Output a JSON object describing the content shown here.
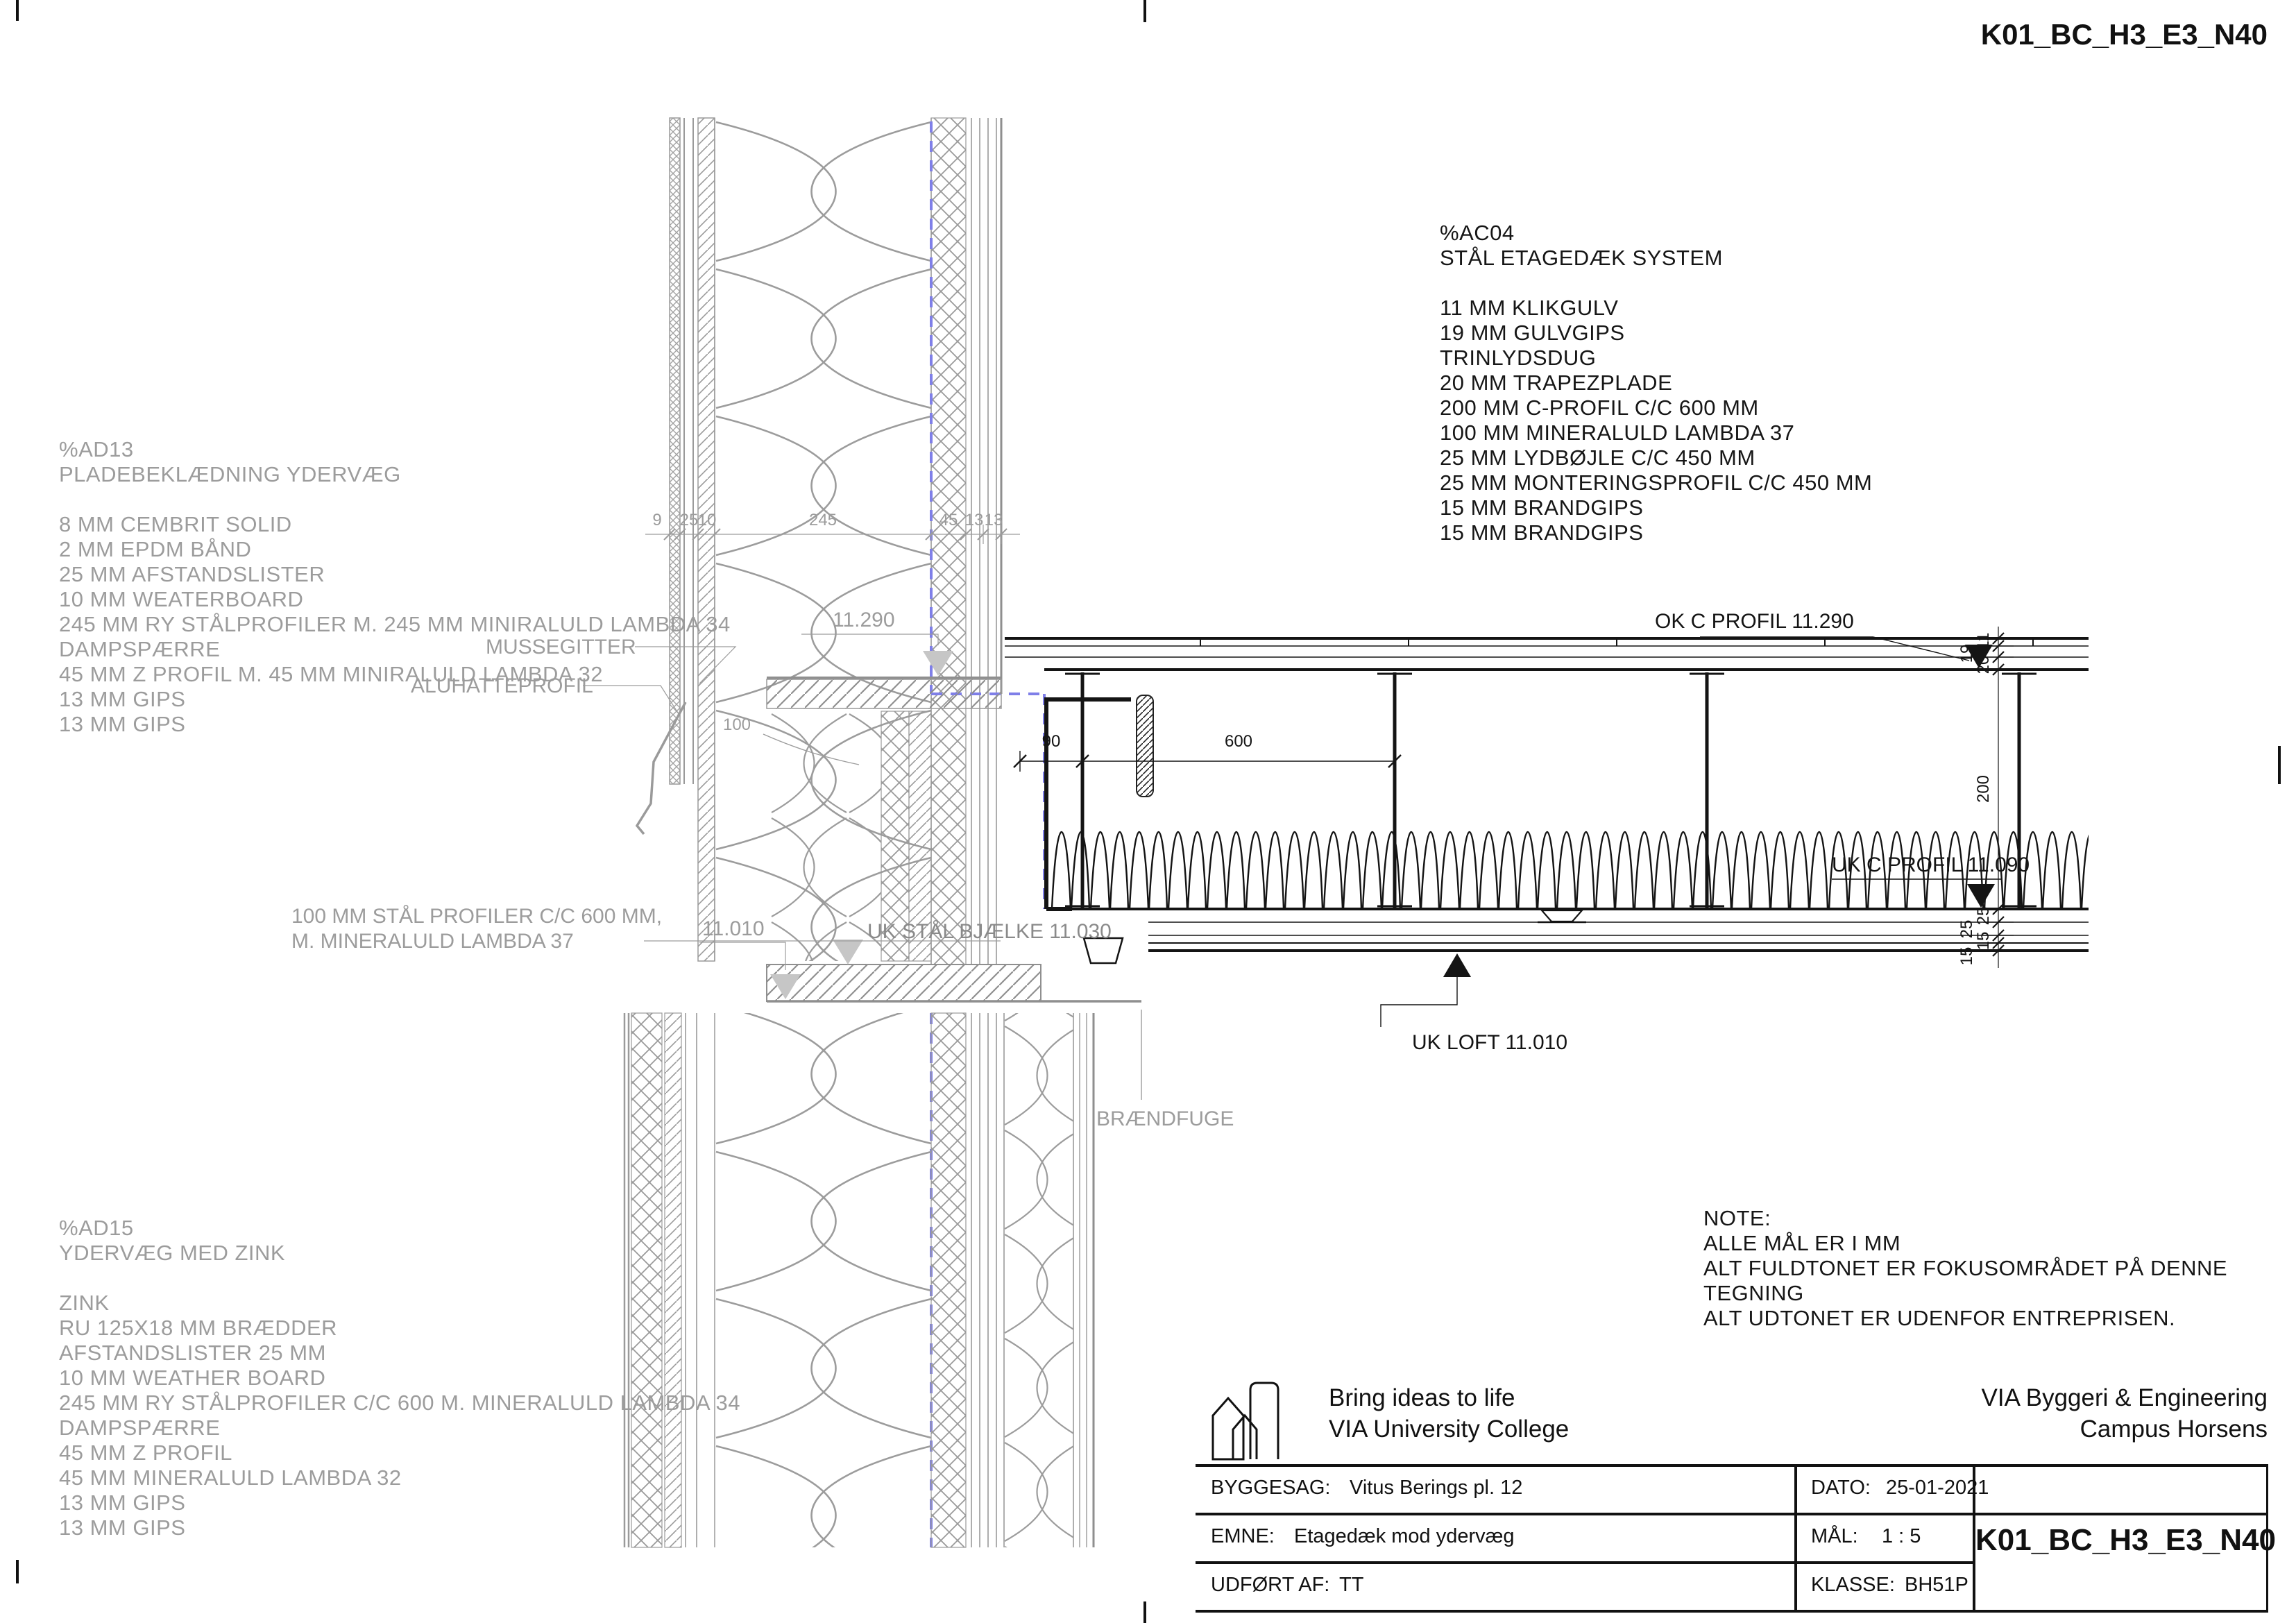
{
  "sheet": {
    "code_top_right": "K01_BC_H3_E3_N40"
  },
  "blocks": {
    "ad13": "%AD13\nPLADEBEKLÆDNING YDERVÆG\n\n8 MM CEMBRIT SOLID\n2 MM EPDM BÅND\n25 MM AFSTANDSLISTER\n10 MM WEATERBOARD\n245 MM RY STÅLPROFILER M. 245 MM MINIRALULD LAMBDA 34\nDAMPSPÆRRE\n45 MM Z PROFIL M. 45 MM MINIRALULD LAMBDA 32\n13 MM GIPS\n13 MM GIPS",
    "ac04": "%AC04\nSTÅL ETAGEDÆK SYSTEM\n\n11 MM KLIKGULV\n19 MM GULVGIPS\nTRINLYDSDUG\n20 MM TRAPEZPLADE\n200 MM C-PROFIL C/C 600 MM\n100 MM MINERALULD LAMBDA 37\n25 MM LYDBØJLE C/C 450 MM\n25 MM MONTERINGSPROFIL C/C 450 MM\n15 MM BRANDGIPS\n15 MM BRANDGIPS",
    "ad15": "%AD15\nYDERVÆG MED ZINK\n\nZINK\nRU 125X18 MM BRÆDDER\nAFSTANDSLISTER 25 MM\n10 MM WEATHER BOARD\n245 MM RY STÅLPROFILER C/C 600 M. MINERALULD LAMBDA 34\nDAMPSPÆRRE\n45 MM Z PROFIL\n45 MM MINERALULD LAMBDA 32\n13 MM GIPS\n13 MM GIPS",
    "note": "NOTE:\nALLE MÅL ER I MM\nALT FULDTONET ER FOKUSOMRÅDET PÅ DENNE TEGNING\nALT UDTONET ER UDENFOR ENTREPRISEN."
  },
  "labels": {
    "ok_c_profil": "OK C PROFIL 11.290",
    "uk_c_profil": "UK C PROFIL 11.090",
    "uk_loft": "UK LOFT 11.010",
    "uk_staal_bjaelke": "UK STÅL BJÆLKE 11.030",
    "level_11290": "11.290",
    "level_11010": "11.010",
    "braendfuge": "BRÆNDFUGE",
    "mussegitter": "MUSSEGITTER",
    "aluhatteprofil": "ALUHATTEPROFIL",
    "staal_profiler_1": "100 MM STÅL PROFILER C/C 600 MM,",
    "staal_profiler_2": "M. MINERALULD LAMBDA 37"
  },
  "dimensions": {
    "top_chain": [
      "9",
      "25",
      "10",
      "245",
      "45",
      "13",
      "13"
    ],
    "right_chain": [
      "11",
      "19",
      "20",
      "200",
      "25",
      "25",
      "15",
      "15"
    ],
    "d90": "90",
    "d600": "600",
    "d100": "100"
  },
  "titleblock": {
    "brand_line1": "Bring ideas to life",
    "brand_line2": "VIA University College",
    "org_line1": "VIA Byggeri & Engineering",
    "org_line2": "Campus Horsens",
    "byggesag_label": "BYGGESAG:",
    "byggesag_value": "Vitus Berings pl. 12",
    "dato_label": "DATO:",
    "dato_value": "25-01-2021",
    "emne_label": "EMNE:",
    "emne_value": "Etagedæk mod ydervæg",
    "maal_label": "MÅL:",
    "maal_value": "1 : 5",
    "udfoert_label": "UDFØRT AF:",
    "udfoert_value": "TT",
    "klasse_label": "KLASSE:",
    "klasse_value": "BH51P",
    "drawing_code": "K01_BC_H3_E3_N40"
  }
}
